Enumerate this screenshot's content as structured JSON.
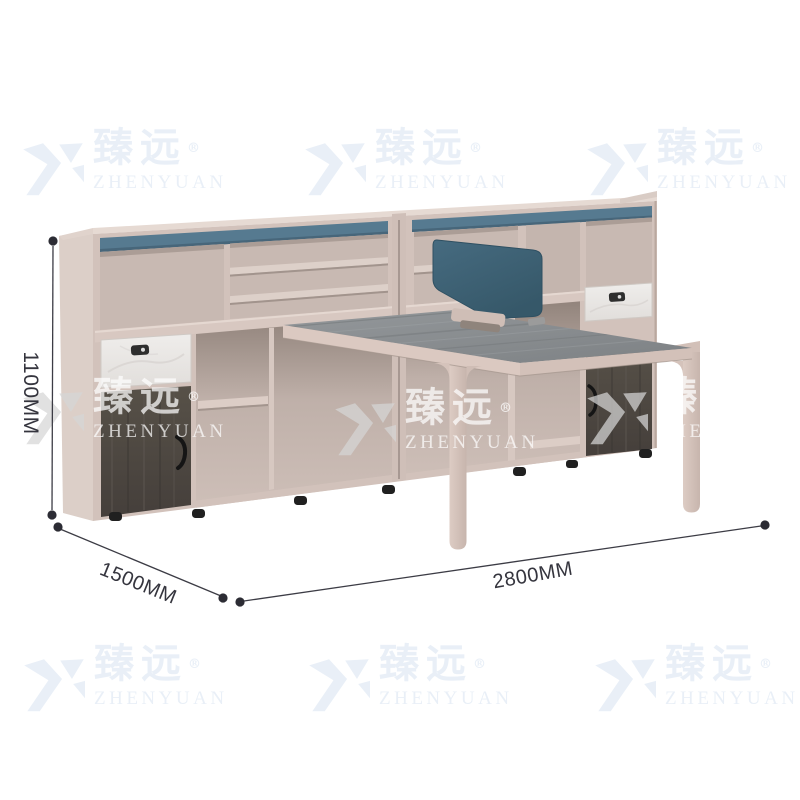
{
  "image": {
    "kind": "furniture product photo",
    "background": "#ffffff",
    "subject": "Office workstation desk with storage bookcase combination and blue privacy screen"
  },
  "watermark": {
    "brand_cn": "臻远",
    "registered": "®",
    "brand_en": "ZHENYUAN"
  },
  "dimensions": {
    "height": "1100MM",
    "depth": "1500MM",
    "width": "2800MM"
  },
  "palette": {
    "cabinet_body": "#d2c2bb",
    "cabinet_side": "#dccfc8",
    "interior": "#c8b9b2",
    "top_accent_blue": "#567a90",
    "privacy_screen_blue": "#3f657a",
    "desktop_gray": "#8a8e91",
    "marble_front": "#ebe9e6",
    "dark_wood": "#4e4944",
    "feet_black": "#202020",
    "dimension_ink": "#3c3c45",
    "watermark_white": "#ffffff",
    "watermark_pale": "#e8eff7"
  }
}
